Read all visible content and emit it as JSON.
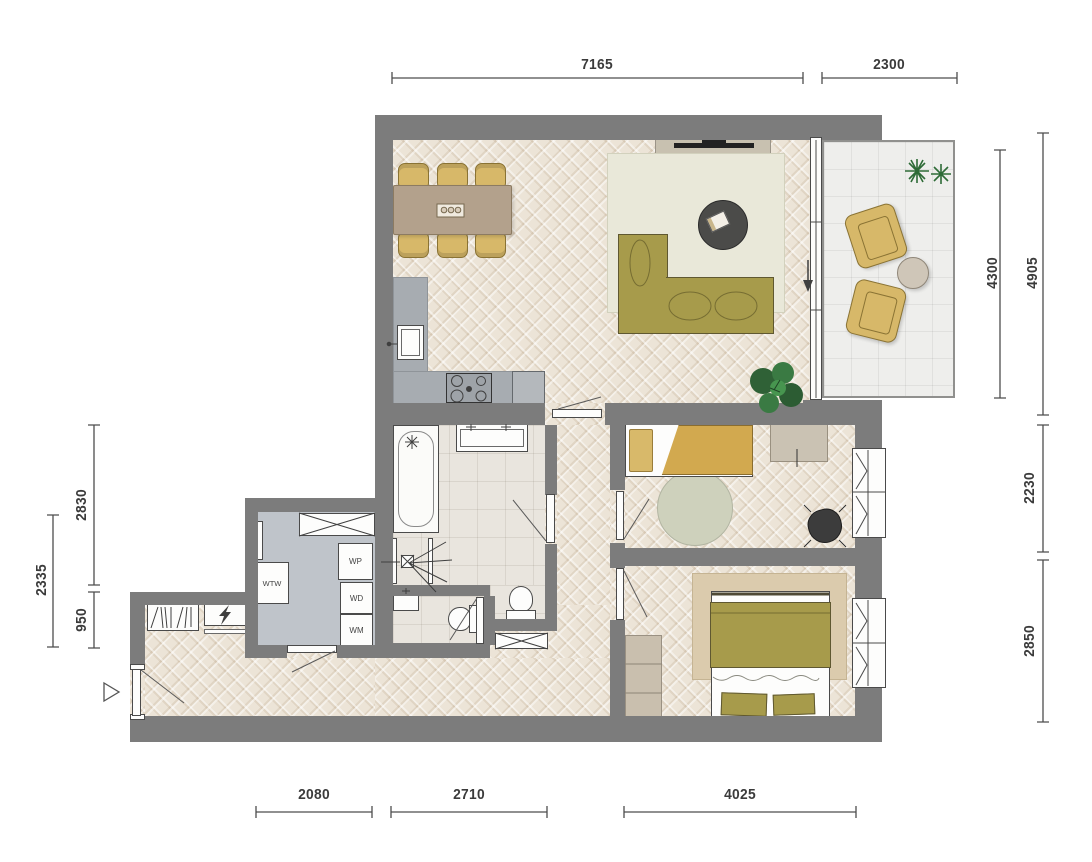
{
  "dims": {
    "top": [
      "7165",
      "2300"
    ],
    "right": [
      "4300",
      "4905",
      "2230",
      "2850"
    ],
    "left": [
      "2830",
      "2335",
      "950"
    ],
    "bottom": [
      "2080",
      "2710",
      "4025"
    ]
  },
  "utility": {
    "units": [
      "WTW",
      "WP",
      "WD",
      "WM"
    ]
  },
  "colors": {
    "wall": "#7c7c7c",
    "wood_floor": "#ece4d7",
    "tile_floor": "#e9e5de",
    "utility_floor": "#bfc4ca",
    "balcony_floor": "#eeeeec",
    "sofa_olive": "#a79b4b",
    "chair_mustard": "#d7b869",
    "counter_gray": "#a7acb1",
    "rug_living": "#e9e8d9",
    "rug_bedroom1": "#ced1bc",
    "rug_bedroom2": "#dbcbad",
    "plant_green": "#2f6136",
    "dimension_line": "#4d4d4d",
    "dimension_text": "#3b3b3b"
  }
}
